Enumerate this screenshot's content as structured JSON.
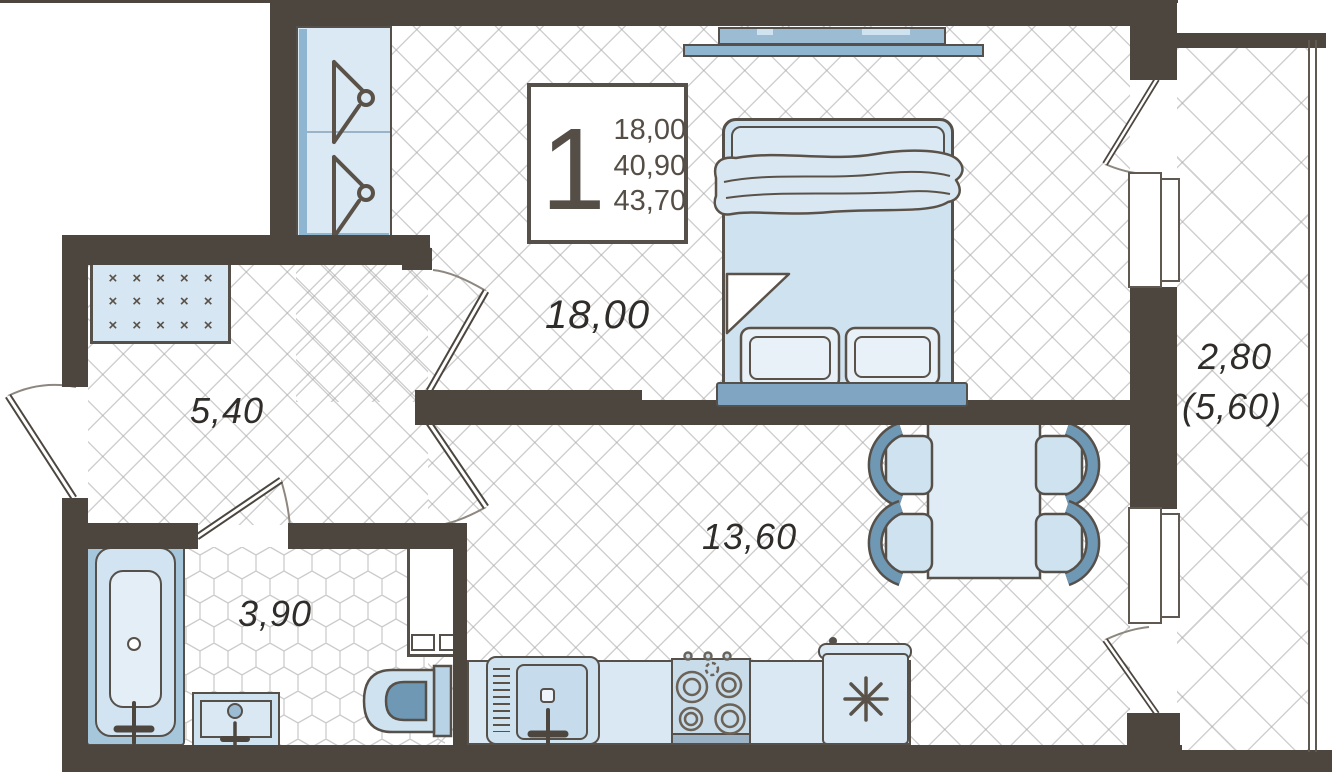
{
  "info_box": {
    "rooms_count": "1",
    "values": [
      "18,00",
      "40,90",
      "43,70"
    ]
  },
  "rooms": {
    "bedroom": {
      "area": "18,00"
    },
    "hallway": {
      "area": "5,40"
    },
    "bathroom": {
      "area": "3,90"
    },
    "kitchen": {
      "area": "13,60"
    },
    "balcony": {
      "area": "2,80",
      "area_secondary": "(5,60)"
    }
  },
  "fixtures": {
    "list": [
      "wardrobe",
      "hanger",
      "shoe-rack",
      "tv",
      "double-bed",
      "pillow",
      "dining-table",
      "chair",
      "fridge",
      "stove",
      "kitchen-sink",
      "bathtub",
      "wash-basin",
      "toilet",
      "storage-cabinet",
      "entrance-door",
      "interior-door",
      "balcony-door",
      "window",
      "balcony-railing"
    ],
    "shoe_rack": {
      "rows": 3,
      "cols": 5,
      "mark": "×"
    }
  },
  "colors": {
    "wall": "#4c463f",
    "outline": "#56504a",
    "fill_light": "#d9e8f3",
    "fill_lighter": "#e9f1f8",
    "fill_medium": "#9cbcd4",
    "fill_accent": "#8fb6d0",
    "fill_dark": "#6f98b5",
    "floor_line": "#c9c9c9"
  }
}
